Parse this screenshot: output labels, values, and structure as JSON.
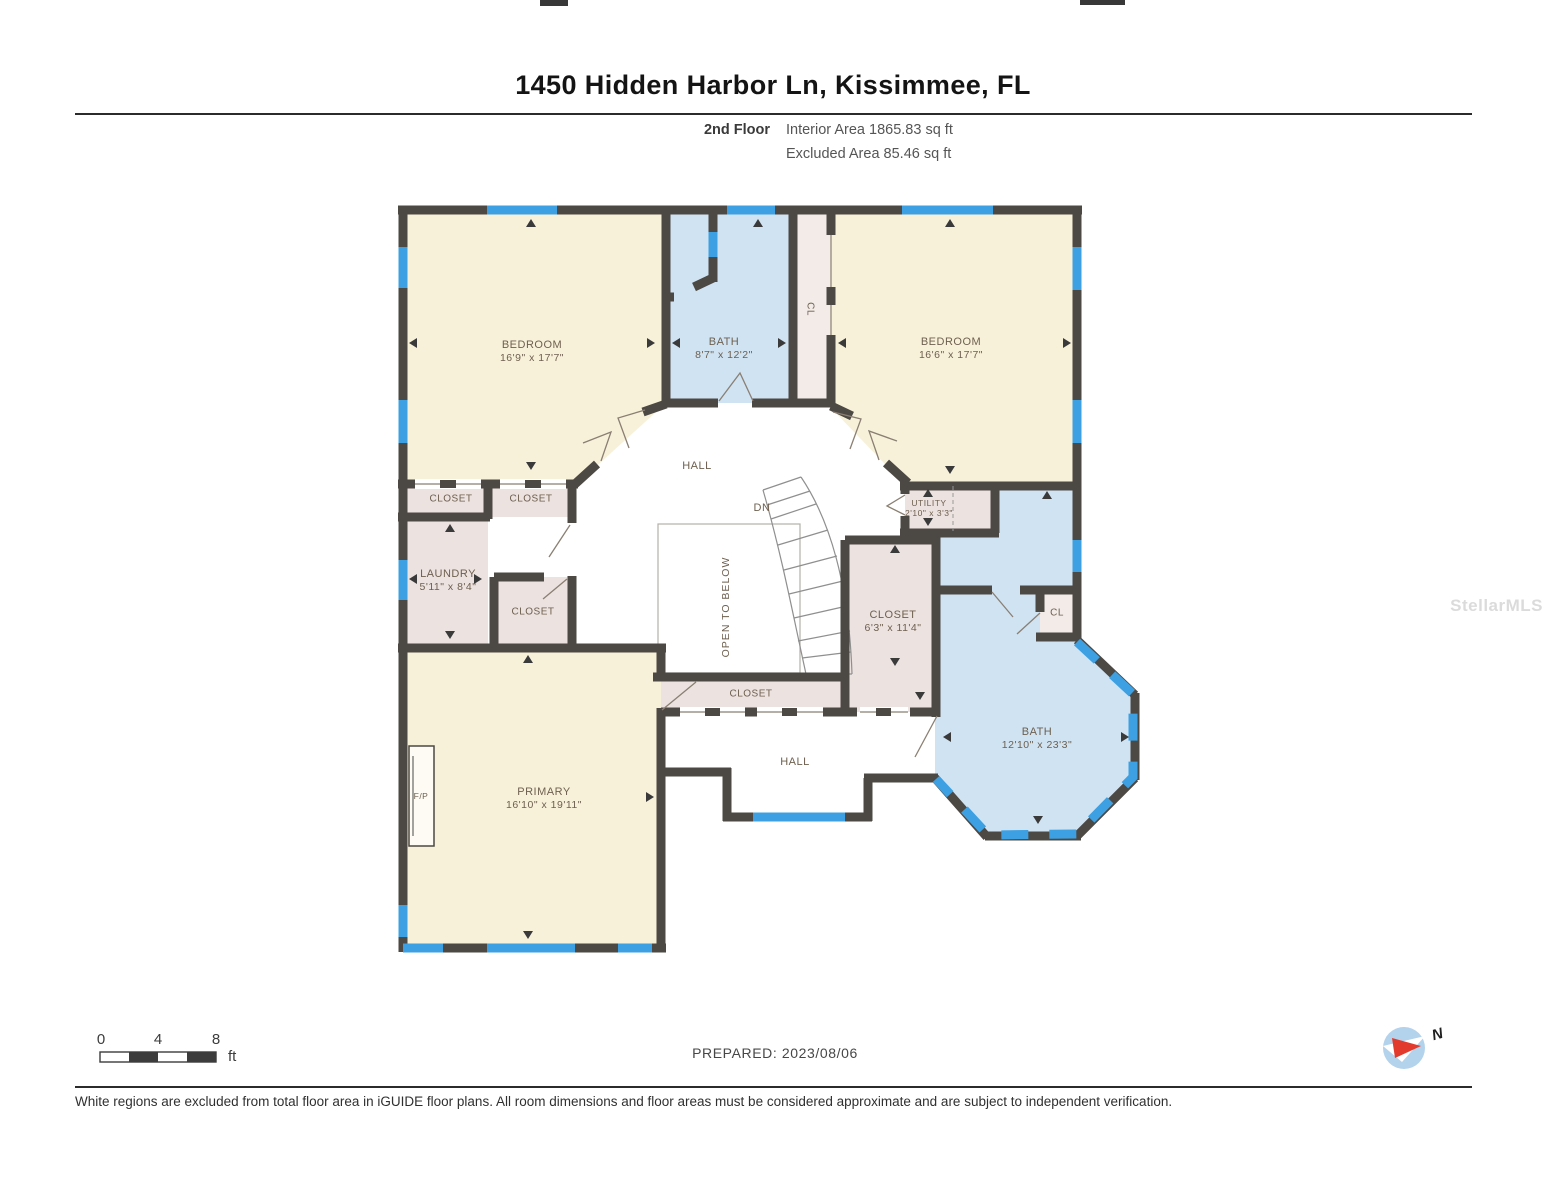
{
  "header": {
    "title": "1450 Hidden Harbor Ln, Kissimmee, FL",
    "floor_label": "2nd Floor",
    "interior_area": "Interior Area 1865.83 sq ft",
    "excluded_area": "Excluded Area 85.46 sq ft"
  },
  "rooms": {
    "bedroom_tl": {
      "name": "BEDROOM",
      "dims": "16'9\" x 17'7\""
    },
    "bath_top": {
      "name": "BATH",
      "dims": "8'7\" x 12'2\""
    },
    "cl_top": {
      "name": "CL"
    },
    "bedroom_tr": {
      "name": "BEDROOM",
      "dims": "16'6\" x 17'7\""
    },
    "hall_upper": {
      "name": "HALL"
    },
    "closet_a": {
      "name": "CLOSET"
    },
    "closet_b": {
      "name": "CLOSET"
    },
    "laundry": {
      "name": "LAUNDRY",
      "dims": "5'11\" x 8'4\""
    },
    "closet_c": {
      "name": "CLOSET"
    },
    "open_to_below": {
      "name": "OPEN TO BELOW"
    },
    "stairs": {
      "name": "DN"
    },
    "utility": {
      "name": "UTILITY",
      "dims": "2'10\" x 3'3\""
    },
    "closet_d": {
      "name": "CLOSET",
      "dims": "6'3\" x 11'4\""
    },
    "cl_right": {
      "name": "CL"
    },
    "bath_main": {
      "name": "BATH",
      "dims": "12'10\" x 23'3\""
    },
    "closet_e": {
      "name": "CLOSET"
    },
    "hall_lower": {
      "name": "HALL"
    },
    "primary": {
      "name": "PRIMARY",
      "dims": "16'10\" x 19'11\""
    },
    "fireplace": {
      "name": "F/P"
    }
  },
  "scale_bar": {
    "tick_0": "0",
    "tick_4": "4",
    "tick_8": "8",
    "unit": "ft"
  },
  "footer": {
    "prepared": "PREPARED: 2023/08/06",
    "compass_label": "N",
    "disclaimer": "White regions are excluded from total floor area in iGUIDE floor plans. All room dimensions and floor areas must be considered approximate and are subject to independent verification."
  },
  "watermark": "StellarMLS",
  "colors": {
    "wall": "#4c4843",
    "window_blue": "#3da0e2",
    "room_beige": "#f8f1da",
    "room_blue": "#cfe3f3",
    "room_pink": "#ece2e0",
    "compass_blue": "#b3d2ec",
    "compass_red": "#e23b2e"
  }
}
